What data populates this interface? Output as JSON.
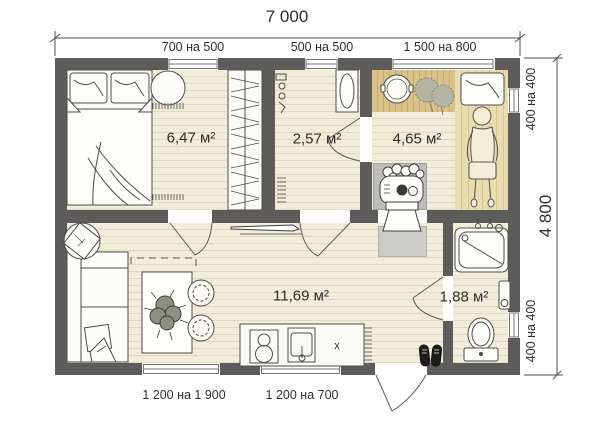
{
  "plan": {
    "dim_top": {
      "overall": "7 000",
      "windows": [
        "700 на 500",
        "500 на 500",
        "1 500 на 800"
      ]
    },
    "dim_right": {
      "overall": "4 800",
      "window_top": "400 на 400",
      "window_bottom": "400 на 400"
    },
    "dim_bottom": {
      "windows": [
        "1 200 на 1 900",
        "1 200 на 700"
      ]
    },
    "rooms": {
      "bedroom": {
        "area": "6,47 м²"
      },
      "washroom": {
        "area": "2,57 м²"
      },
      "steamroom": {
        "area": "4,65 м²"
      },
      "lounge": {
        "area": "11,69 м²"
      },
      "bathroom": {
        "area": "1,88 м²"
      }
    },
    "markings": {
      "counter_mark": "х"
    },
    "colors": {
      "wall": "#5d5c5a",
      "floor": "#f1edda",
      "plank_line": "#e0d9be",
      "bench": "#d9c28a",
      "pad": "#bdbdbb",
      "text": "#2e2e2e"
    }
  }
}
